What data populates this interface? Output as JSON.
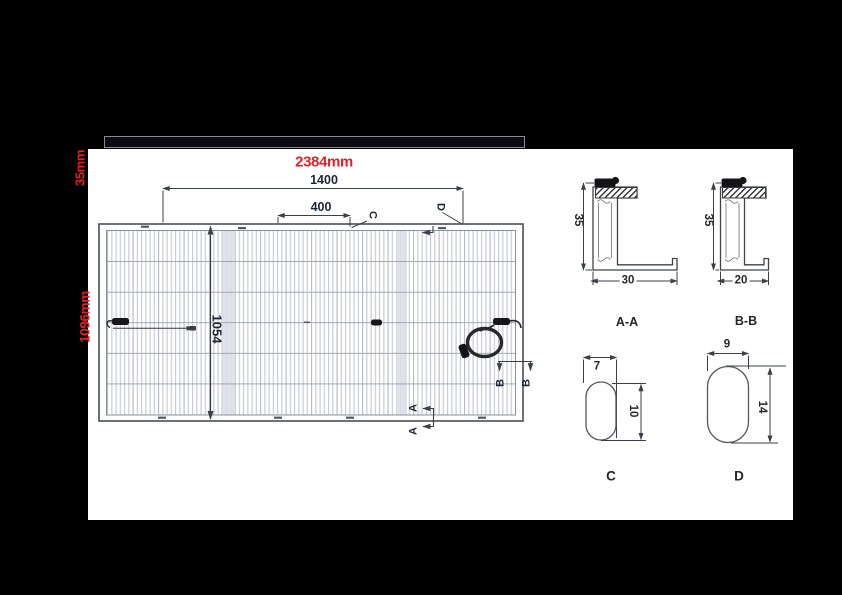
{
  "colors": {
    "accent_red": "#e81d25",
    "dimension_line": "#3a3f4a",
    "navy_text": "#1d2433",
    "black_text": "#26262a"
  },
  "annotations": {
    "panel_width": "2384mm",
    "panel_height": "1096mm",
    "frame_thickness": "35mm"
  },
  "main_drawing": {
    "dim_top_outer": "1400",
    "dim_top_inner": "400",
    "dim_vertical": "1054",
    "cut_c": "C",
    "cut_d": "D",
    "cut_a_1": "A",
    "cut_a_2": "A",
    "cut_b_1": "B",
    "cut_b_2": "B"
  },
  "sections": {
    "aa": {
      "label": "A-A",
      "height": "35",
      "width": "30"
    },
    "bb": {
      "label": "B-B",
      "height": "35",
      "width": "20"
    }
  },
  "details": {
    "c": {
      "label": "C",
      "width": "7",
      "height": "10"
    },
    "d": {
      "label": "D",
      "width": "9",
      "height": "14"
    }
  }
}
